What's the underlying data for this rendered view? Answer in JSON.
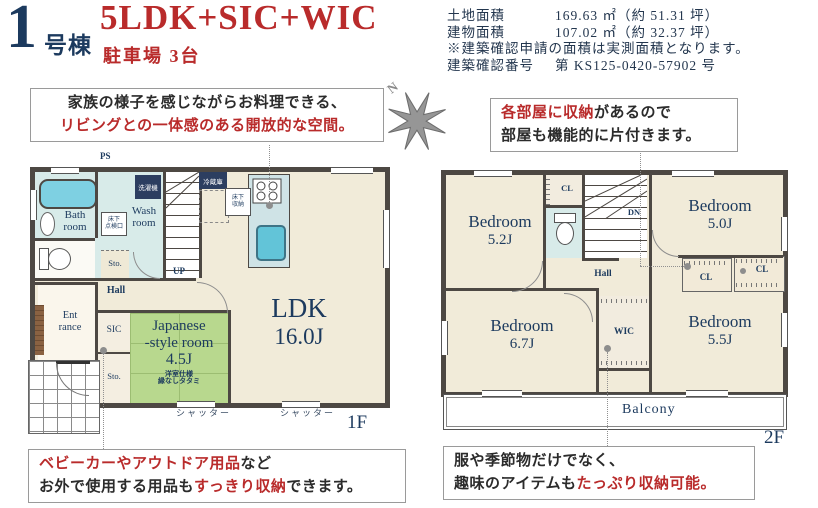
{
  "header": {
    "unit_number": "1",
    "unit_label": "号棟",
    "plan_title": "5LDK+SIC+WIC",
    "parking": "駐車場 3台"
  },
  "site_info": {
    "land_label": "土地面積",
    "land_value": "169.63 ㎡（約 51.31 坪）",
    "building_label": "建物面積",
    "building_value": "107.02 ㎡（約 32.37 坪）",
    "note": "※建築確認申請の面積は実測面積となります。",
    "confirmation_label": "建築確認番号",
    "confirmation_value": "第 KS125-0420-57902 号"
  },
  "compass": {
    "north": "N"
  },
  "callouts": {
    "kitchen": {
      "line1": "家族の様子を感じながらお料理できる、",
      "line2": "リビングとの一体感のある開放的な空間。"
    },
    "bedroom_storage": {
      "line1_red": "各部屋に収納",
      "line1_black": "があるので",
      "line2": "部屋も機能的に片付きます。"
    },
    "sic": {
      "line1_red": "ベビーカーやアウトドア用品",
      "line1_black": "など",
      "line2_black1": "お外で使用する用品も",
      "line2_red": "すっきり収納",
      "line2_black2": "できます。"
    },
    "wic": {
      "line1": "服や季節物だけでなく、",
      "line2_black": "趣味のアイテムも",
      "line2_red": "たっぷり収納可能。"
    }
  },
  "floor1": {
    "floor_label": "1F",
    "ldk_name": "LDK",
    "ldk_size": "16.0J",
    "japanese_room_line1": "Japanese",
    "japanese_room_line2": "-style room",
    "japanese_room_size": "4.5J",
    "tatami_note_line1": "洋室仕様",
    "tatami_note_line2": "縁なしタタミ",
    "bath_line1": "Bath",
    "bath_line2": "room",
    "wash_line1": "Wash",
    "wash_line2": "room",
    "hall": "Hall",
    "entrance_line1": "Ent",
    "entrance_line2": "rance",
    "sic": "SIC",
    "storage": "Sto.",
    "storage2": "Sto.",
    "up": "UP",
    "ps": "PS",
    "washer": "洗濯機",
    "fridge": "冷蔵庫",
    "inspection_line1": "床下",
    "inspection_line2": "点検口",
    "cupboard_line1": "床下",
    "cupboard_line2": "収納",
    "shutter": "シャッター"
  },
  "floor2": {
    "floor_label": "2F",
    "bedroom1_name": "Bedroom",
    "bedroom1_size": "5.2J",
    "bedroom2_name": "Bedroom",
    "bedroom2_size": "5.0J",
    "bedroom3_name": "Bedroom",
    "bedroom3_size": "6.7J",
    "bedroom4_name": "Bedroom",
    "bedroom4_size": "5.5J",
    "hall": "Hall",
    "wic": "WIC",
    "cl": "CL",
    "dn": "DN",
    "balcony": "Balcony"
  },
  "colors": {
    "accent_red": "#b92b2b",
    "navy": "#1c3a5e",
    "wall_gray": "#4d4843",
    "tatami_green": "#b8d88e",
    "wet_blue": "#d8ebe9",
    "floor_beige": "#f1ebd9"
  }
}
